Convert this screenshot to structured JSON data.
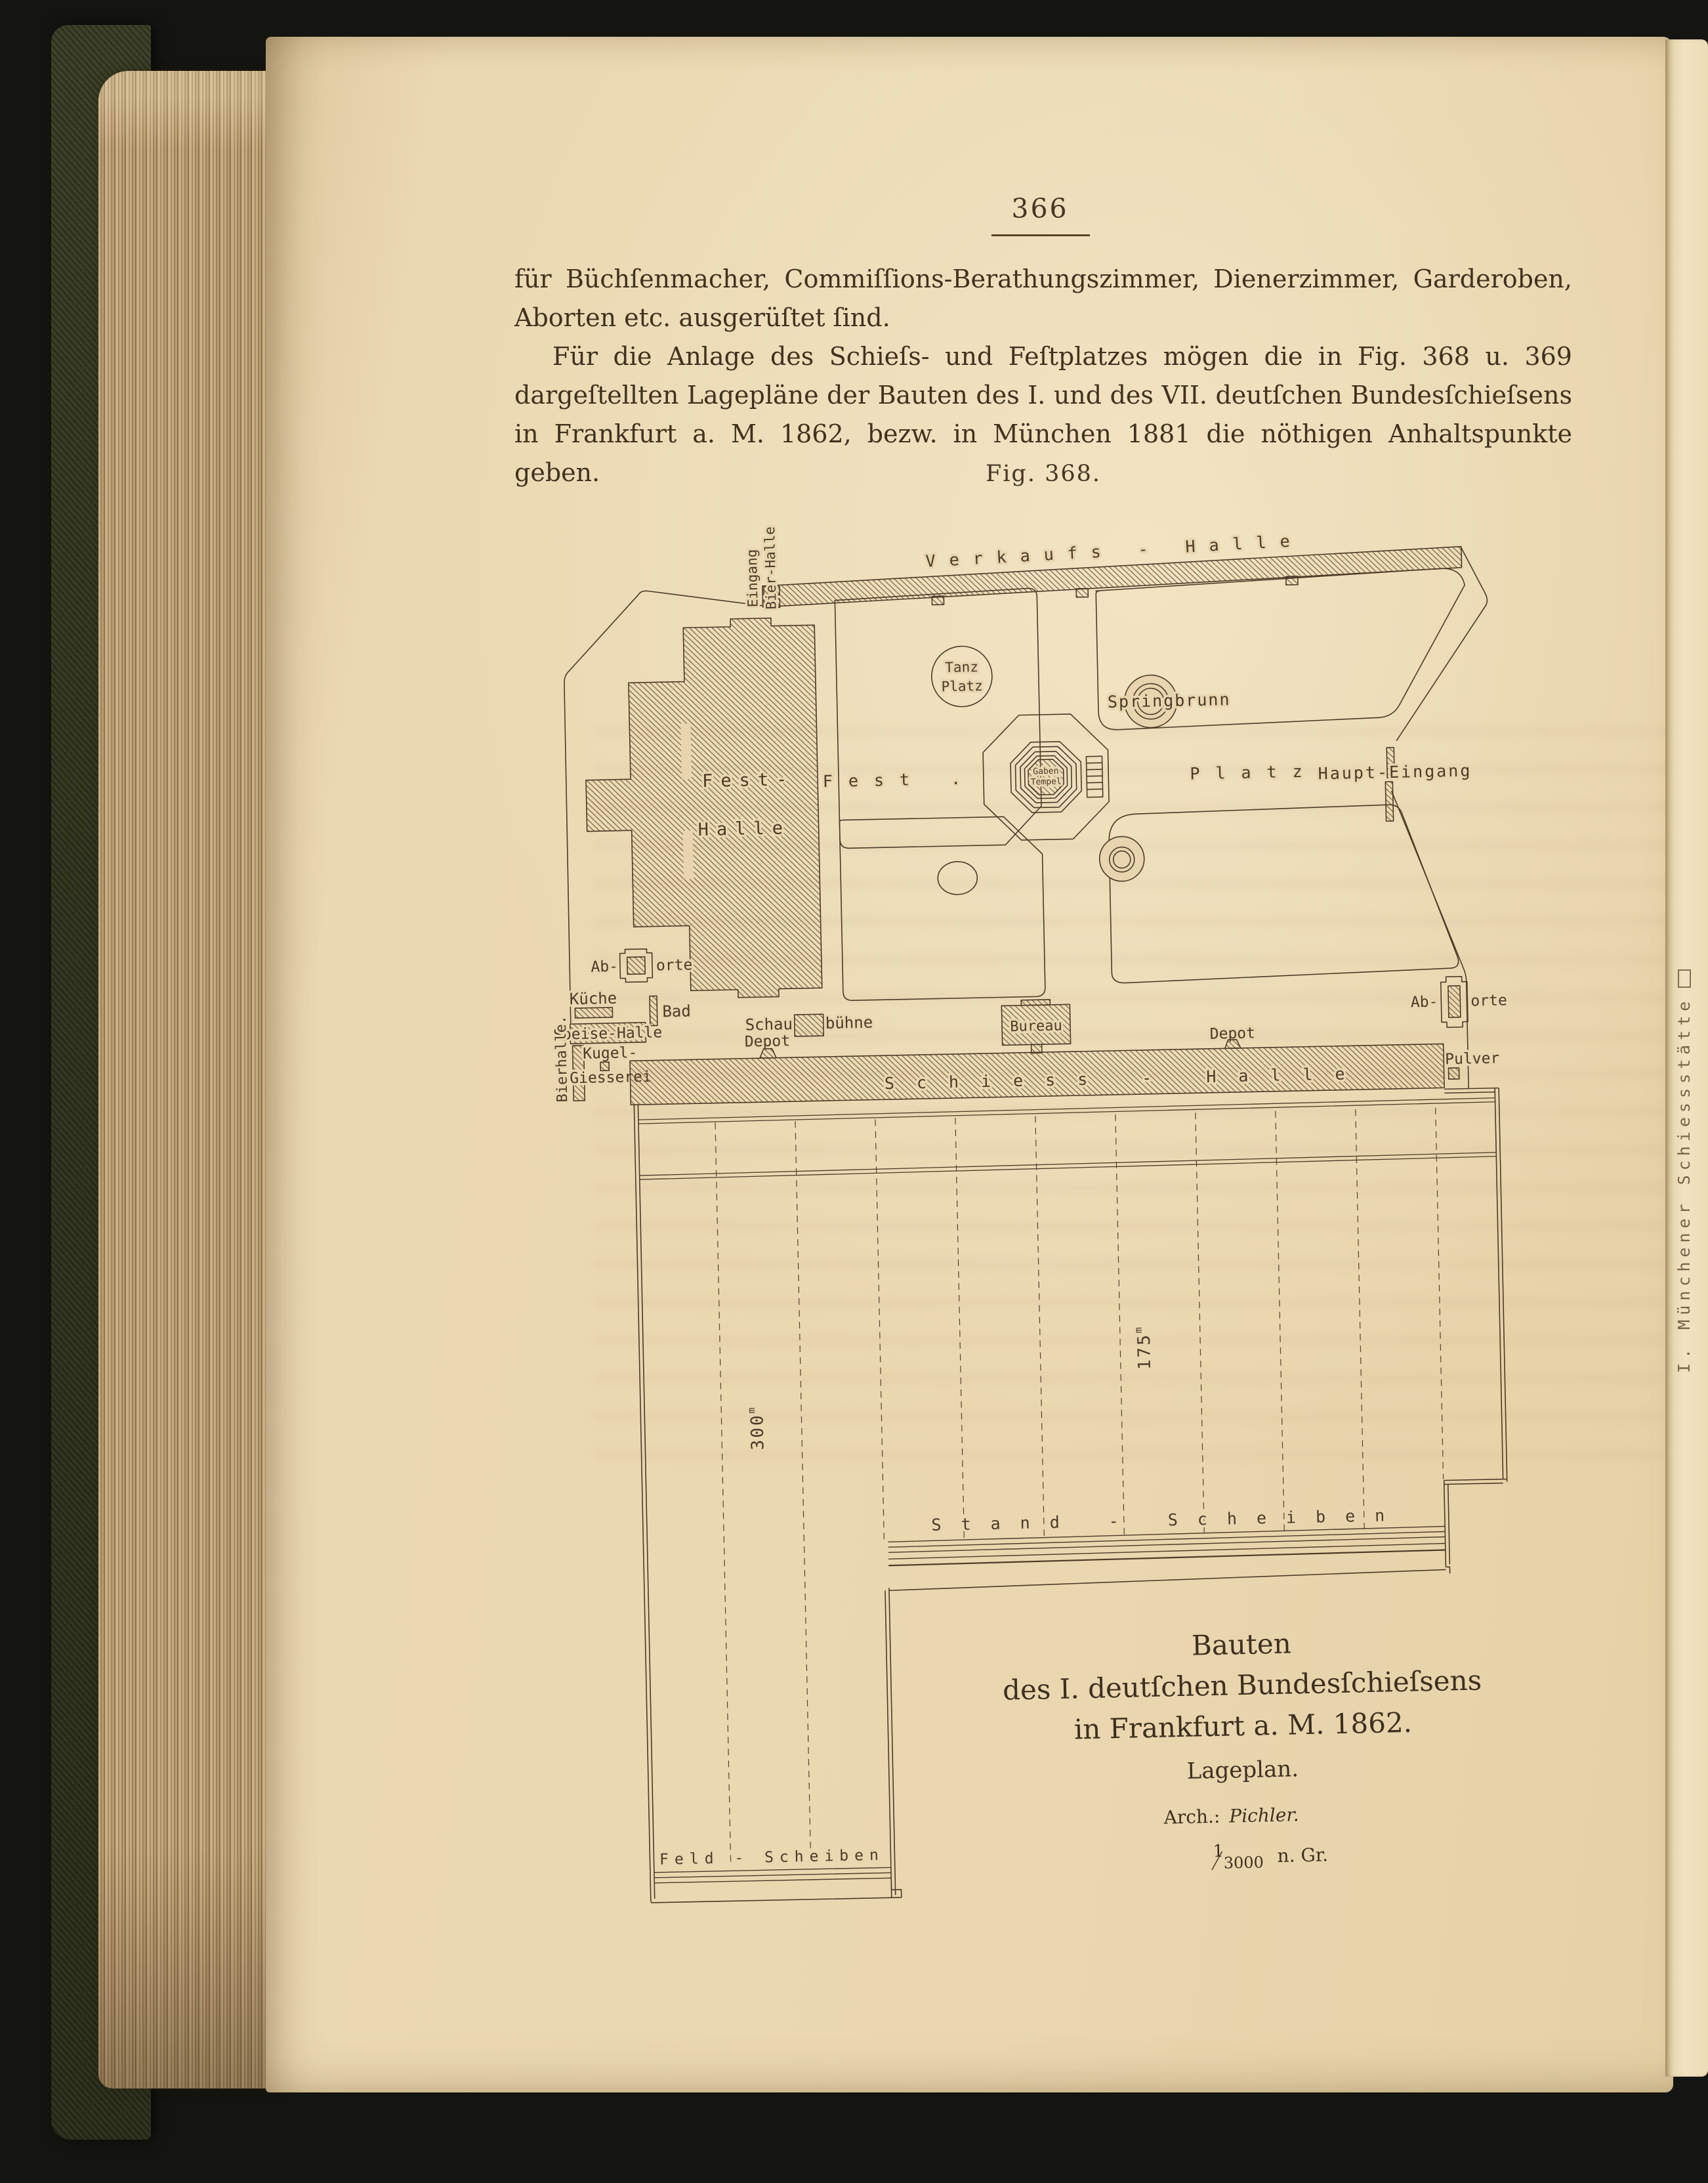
{
  "colors": {
    "paper": "#e8d5af",
    "paper_light": "#f0e2c2",
    "ink_text": "#41321f",
    "ink_plan": "#4c3a27",
    "cover_green": "#343821",
    "scan_background": "#141410"
  },
  "book": {
    "page_number": "366",
    "paragraph1_lines": [
      "für Büchſenmacher, Commiſſions-Berathungszimmer, Dienerzimmer, Garderoben,",
      "Aborten etc. ausgerüſtet ſind."
    ],
    "paragraph2_lines": [
      "Für die Anlage des Schieſs- und Feſtplatzes mögen die in Fig. 368 u. 369",
      "dargeſtellten Lagepläne der Bauten des I. und des VII. deutſchen Bundesſchieſsens",
      "in Frankfurt a. M. 1862, bezw. in München 1881 die nöthigen Anhaltspunkte geben."
    ],
    "figure_label": "Fig. 368.",
    "edge_text": "I. Münchener Schiessstätte"
  },
  "plan": {
    "labels": {
      "verkaufs_halle": "Verkaufs - Halle",
      "eingang": "Eingang",
      "bier_halle": "Bier-Halle",
      "fest_halle_1": "Fest-",
      "fest_halle_2": "Halle",
      "tanz_1": "Tanz",
      "tanz_2": "Platz",
      "springbrunn": "Springbrunn",
      "fest_platz_1": "Fest .",
      "fest_platz_2": "Platz",
      "gaben_1": "Gaben",
      "gaben_2": "Tempel",
      "haupt_eingang": "Haupt-Eingang",
      "aborte_a": "Ab-",
      "aborte_b": "orte",
      "kueche": "Küche",
      "bad": "Bad",
      "speise_halle": "Speise-Halle",
      "bierhalle": "Bierhalle.",
      "kugel": "Kugel-",
      "giesserei": "Giesserei",
      "schau": "Schau",
      "buehne": "bühne",
      "depot": "Depot",
      "bureau": "Bureau",
      "pulver": "Pulver",
      "schiess_halle": "Schiess - Halle",
      "stand_scheiben": "Stand - Scheiben",
      "feld_scheiben": "Feld - Scheiben",
      "dist_300": "300",
      "dist_175": "175",
      "meter": "m"
    },
    "caption": {
      "title_1": "Bauten",
      "title_2": "des I. deutſchen Bundesſchieſsens",
      "title_3": "in Frankfurt a. M. 1862.",
      "subtitle": "Lageplan.",
      "arch_label": "Arch.:",
      "arch_name": "Pichler.",
      "scale_num": "1",
      "scale_den": "3000",
      "scale_suffix": "n. Gr."
    }
  }
}
